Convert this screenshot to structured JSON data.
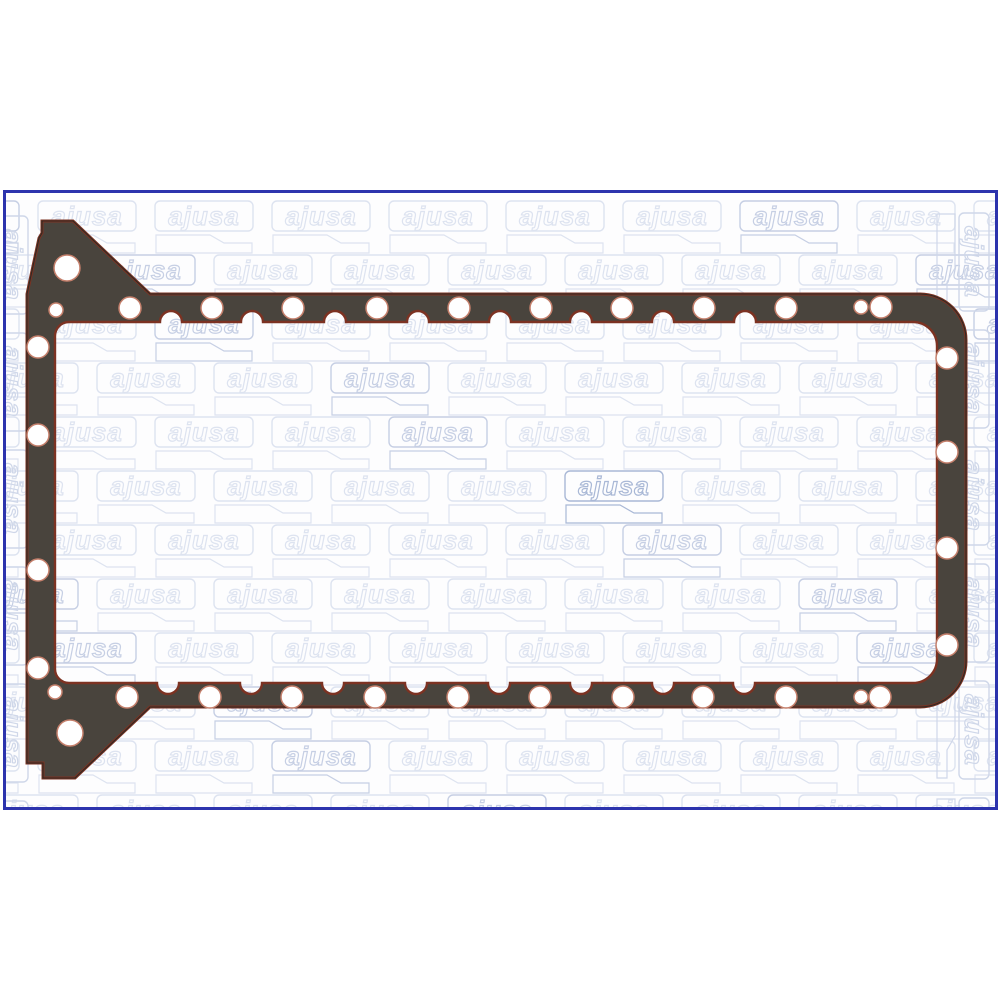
{
  "image": {
    "type": "product-photo",
    "subject": "engine oil sump (oil pan) gasket",
    "orientation": "horizontal rectangular gasket with angled mounting wings on the left side"
  },
  "frame": {
    "border_color": "#2c33ad",
    "background_color": "#fdfdfe",
    "page_background": "#ffffff"
  },
  "watermark": {
    "text": "ajusa",
    "base_color": "#dde3f0",
    "mid_color": "#c6cfe4",
    "dark_color": "#a9b8d6",
    "edge_color": "#cfd7e9"
  },
  "gasket": {
    "body_color": "#49443d",
    "edge_dark_color": "#2e2a25",
    "bead_color": "#7c3222",
    "hole_fill": "#ffffff",
    "hole_ring_color": "#c47f6b",
    "holes": [
      [
        130,
        308,
        11
      ],
      [
        212,
        308,
        11
      ],
      [
        293,
        308,
        11
      ],
      [
        377,
        308,
        11
      ],
      [
        459,
        308,
        11
      ],
      [
        541,
        308,
        11
      ],
      [
        622,
        308,
        11
      ],
      [
        704,
        308,
        11
      ],
      [
        786,
        308,
        11
      ],
      [
        861,
        307,
        7
      ],
      [
        881,
        307,
        11
      ],
      [
        947,
        358,
        11
      ],
      [
        947,
        452,
        11
      ],
      [
        947,
        548,
        11
      ],
      [
        947,
        645,
        11
      ],
      [
        127,
        697,
        11
      ],
      [
        210,
        697,
        11
      ],
      [
        292,
        697,
        11
      ],
      [
        375,
        697,
        11
      ],
      [
        458,
        697,
        11
      ],
      [
        540,
        697,
        11
      ],
      [
        623,
        697,
        11
      ],
      [
        703,
        697,
        11
      ],
      [
        786,
        697,
        11
      ],
      [
        861,
        697,
        7
      ],
      [
        880,
        697,
        11
      ],
      [
        38,
        347,
        11
      ],
      [
        38,
        435,
        11
      ],
      [
        38,
        570,
        11
      ],
      [
        38,
        668,
        11
      ],
      [
        56,
        310,
        7
      ],
      [
        55,
        692,
        7
      ],
      [
        67,
        268,
        13
      ],
      [
        70,
        733,
        13
      ]
    ],
    "scallops_top": [
      171,
      252,
      335,
      418,
      500,
      581,
      663,
      745
    ],
    "scallops_top_y": 322,
    "scallops_bottom": [
      168,
      251,
      333,
      416,
      499,
      581,
      663,
      744
    ],
    "scallops_bottom_y": 683,
    "scallop_radius": 11
  }
}
